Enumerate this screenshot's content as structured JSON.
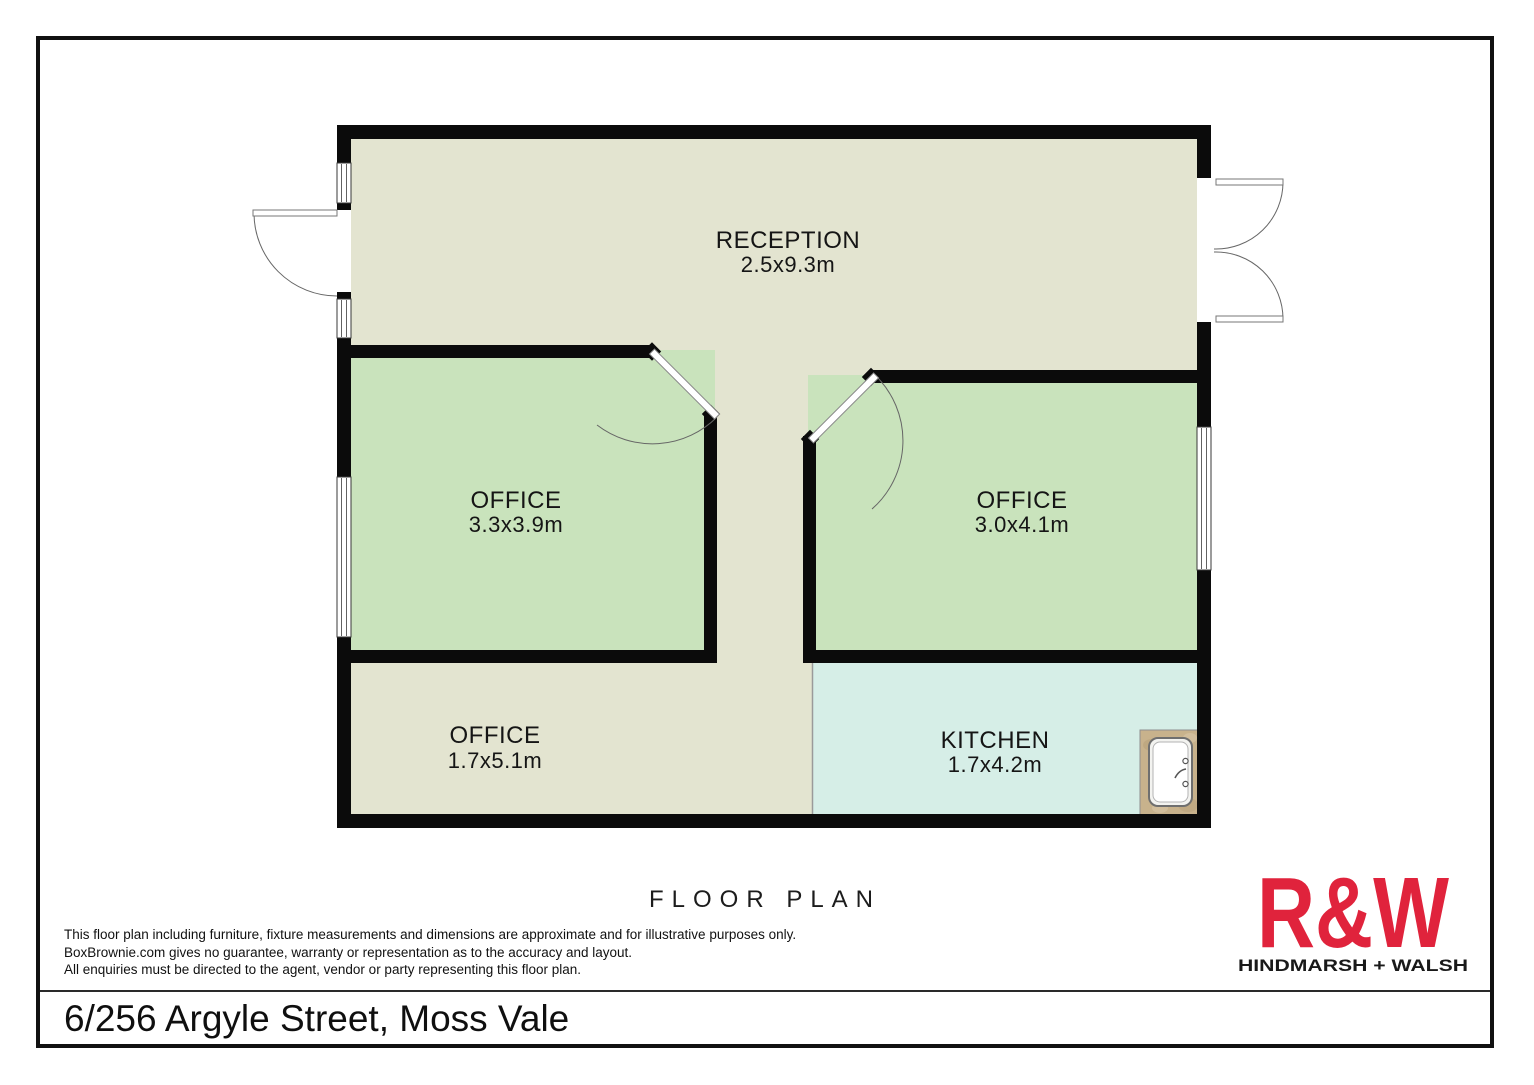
{
  "floor_plan": {
    "heading": "FLOOR PLAN",
    "wall_color": "#0b0b0b",
    "rooms": [
      {
        "id": "reception",
        "name": "RECEPTION",
        "dimensions": "2.5x9.3m",
        "floor_color": "#e3e4d0"
      },
      {
        "id": "office-left",
        "name": "OFFICE",
        "dimensions": "3.3x3.9m",
        "floor_color": "#c9e3bc"
      },
      {
        "id": "office-right",
        "name": "OFFICE",
        "dimensions": "3.0x4.1m",
        "floor_color": "#c9e3bc"
      },
      {
        "id": "office-bottom",
        "name": "OFFICE",
        "dimensions": "1.7x5.1m",
        "floor_color": "#e3e4d0"
      },
      {
        "id": "kitchen",
        "name": "KITCHEN",
        "dimensions": "1.7x4.2m",
        "floor_color": "#d6eee7"
      }
    ]
  },
  "disclaimer": {
    "lines": [
      "This floor plan including furniture, fixture measurements and dimensions are approximate and for illustrative purposes only.",
      "BoxBrownie.com gives no guarantee, warranty or representation as to the accuracy and layout.",
      "All enquiries must be directed to the agent, vendor or party representing this floor plan."
    ]
  },
  "branding": {
    "logo": "R&W",
    "agency": "HINDMARSH + WALSH",
    "logo_color": "#e0233c"
  },
  "address": "6/256 Argyle Street, Moss Vale"
}
